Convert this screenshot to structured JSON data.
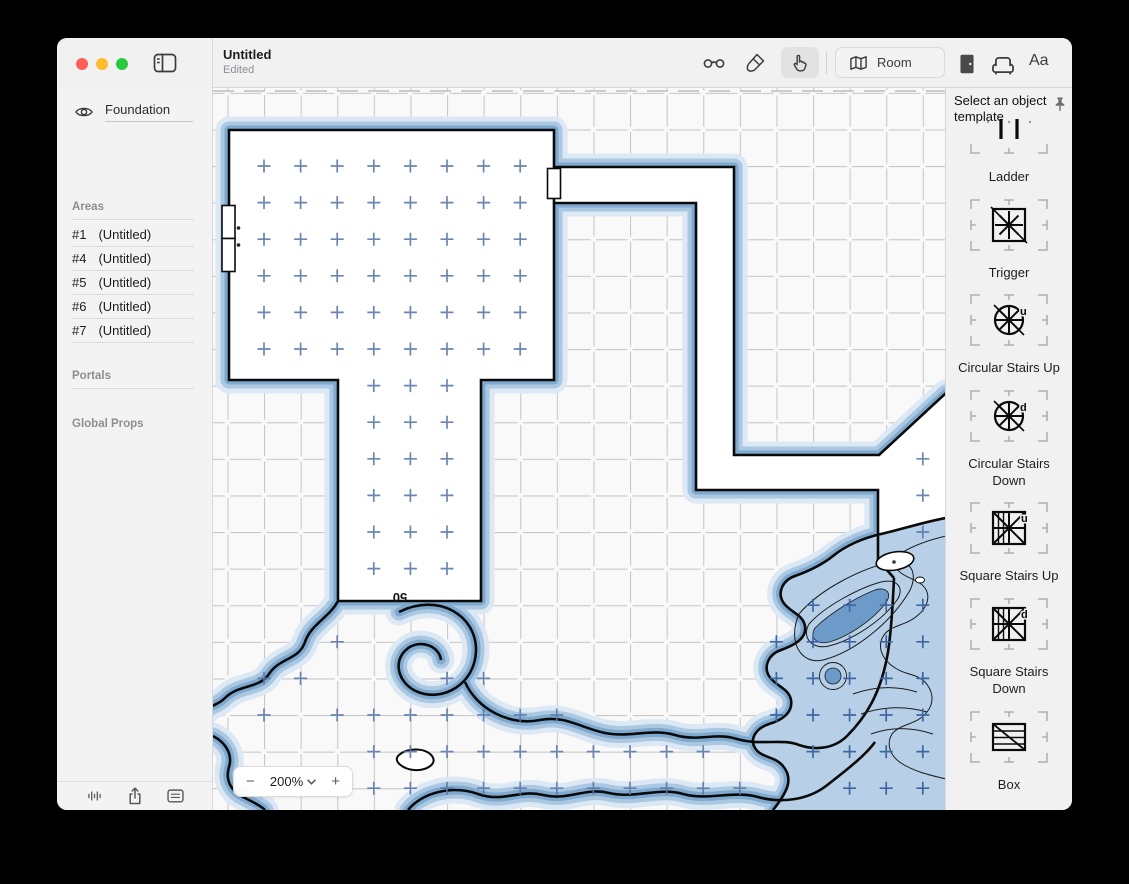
{
  "window": {
    "title": "Untitled",
    "subtitle": "Edited"
  },
  "toolbar": {
    "room_label": "Room",
    "text_style_label": "Aa"
  },
  "sidebar": {
    "layer_name": "Foundation",
    "areas_label": "Areas",
    "areas": [
      {
        "num": "#1",
        "name": "(Untitled)"
      },
      {
        "num": "#4",
        "name": "(Untitled)"
      },
      {
        "num": "#5",
        "name": "(Untitled)"
      },
      {
        "num": "#6",
        "name": "(Untitled)"
      },
      {
        "num": "#7",
        "name": "(Untitled)"
      }
    ],
    "portals_label": "Portals",
    "global_props_label": "Global Props"
  },
  "canvas": {
    "zoom_level": "200%",
    "zoom_out": "−",
    "zoom_in": "+",
    "room_size_label": "50"
  },
  "right_panel": {
    "header": "Select an object template",
    "templates": [
      "Ladder",
      "Trigger",
      "Circular Stairs Up",
      "Circular Stairs Down",
      "Square Stairs Up",
      "Square Stairs Down",
      "Box"
    ],
    "stairs_up_letter": "u",
    "stairs_down_letter": "d"
  },
  "colors": {
    "wall": "#0a0a0a",
    "glow_outer": "#dce8f4",
    "glow_mid": "#abc8e2",
    "glow_inner": "#7fa9ce",
    "water_fill": "#b7d0e7",
    "water_deep": "#6d9bc9",
    "cross_blue": "#5b79a8",
    "cross_water": "#3f66a0",
    "traffic_red": "#ff5f57",
    "traffic_yellow": "#febc2e",
    "traffic_green": "#28c840"
  },
  "canvas_map": {
    "cross_groups": [
      {
        "target": "crosses-room",
        "xs": [
          51,
          87.6,
          124.2,
          160.8,
          197.4,
          234,
          270.6,
          307.2
        ],
        "ys": [
          78,
          114.6,
          151.2,
          187.8,
          224.4,
          261
        ]
      },
      {
        "target": "crosses-room",
        "xs": [
          160.8,
          197.4,
          234
        ],
        "ys": [
          297.6,
          334.2,
          370.8,
          407.4,
          444,
          480.6
        ]
      },
      {
        "target": "crosses-room",
        "rows": [
          {
            "y": 370.8,
            "xs": [
              709.8
            ]
          },
          {
            "y": 407.4,
            "xs": [
              709.8
            ]
          },
          {
            "y": 444,
            "xs": [
              709.8
            ]
          }
        ]
      },
      {
        "target": "crosses-floor",
        "rows": [
          {
            "y": 553.8,
            "xs": [
              124.2
            ]
          },
          {
            "y": 590.4,
            "xs": [
              51,
              87.6,
              234,
              270.6
            ]
          },
          {
            "y": 627,
            "xs": [
              51,
              124.2,
              160.8,
              197.4,
              234,
              270.6,
              307.2,
              343.8
            ]
          },
          {
            "y": 663.6,
            "xs": [
              160.8,
              197.4,
              234,
              270.6,
              307.2,
              343.8,
              380.4,
              417,
              453.6,
              490.2
            ]
          },
          {
            "y": 700.2,
            "xs": [
              160.8,
              197.4,
              234,
              270.6,
              307.2,
              343.8,
              380.4,
              417,
              453.6,
              490.2,
              526.8
            ]
          }
        ]
      },
      {
        "target": "crosses-water",
        "rows": [
          {
            "y": 517.2,
            "xs": [
              600,
              636.6,
              673.2,
              709.8
            ]
          },
          {
            "y": 553.8,
            "xs": [
              563.4,
              600,
              636.6,
              673.2,
              709.8
            ]
          },
          {
            "y": 590.4,
            "xs": [
              563.4,
              600,
              636.6,
              673.2,
              709.8
            ]
          },
          {
            "y": 627,
            "xs": [
              563.4,
              600,
              636.6,
              673.2,
              709.8
            ]
          },
          {
            "y": 663.6,
            "xs": [
              600,
              636.6,
              673.2,
              709.8
            ]
          },
          {
            "y": 700.2,
            "xs": [
              636.6,
              673.2,
              709.8
            ]
          }
        ]
      }
    ]
  }
}
